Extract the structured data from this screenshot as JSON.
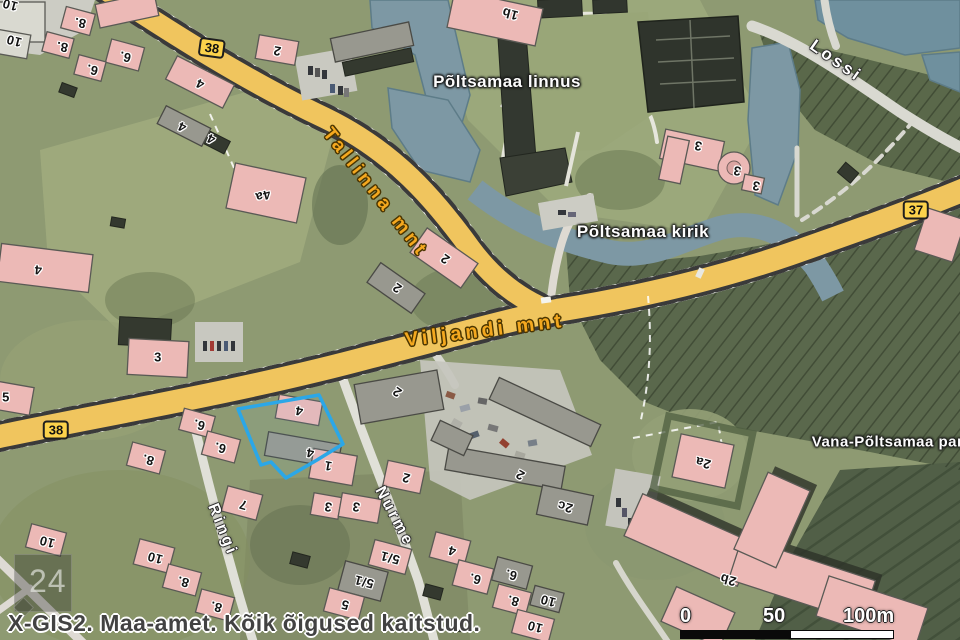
{
  "app": {
    "attribution": "X-GIS2. Maa-amet. Kõik õigused kaitstud."
  },
  "scalebar": {
    "start": "0",
    "mid": "50",
    "end": "100m"
  },
  "grid": {
    "sheet": "24"
  },
  "roads": {
    "names": [
      {
        "text": "Tallinna mnt"
      },
      {
        "text": "Viljandi mnt"
      },
      {
        "text": "Lossi"
      },
      {
        "text": "Nurme"
      },
      {
        "text": "Ringi"
      }
    ],
    "badges": [
      {
        "text": "38"
      },
      {
        "text": "37"
      },
      {
        "text": "38"
      }
    ]
  },
  "pois": [
    {
      "text": "Põltsamaa linnus"
    },
    {
      "text": "Põltsamaa kirik"
    },
    {
      "text": "Vana-Põltsamaa park"
    }
  ],
  "houses": [
    {
      "text": "10"
    },
    {
      "text": "8."
    },
    {
      "text": "10"
    },
    {
      "text": "8."
    },
    {
      "text": "6."
    },
    {
      "text": "6."
    },
    {
      "text": "4"
    },
    {
      "text": "4"
    },
    {
      "text": "4"
    },
    {
      "text": "2"
    },
    {
      "text": "4a"
    },
    {
      "text": "4"
    },
    {
      "text": "1b"
    },
    {
      "text": "2"
    },
    {
      "text": "2"
    },
    {
      "text": "3"
    },
    {
      "text": "3"
    },
    {
      "text": "3"
    },
    {
      "text": "3"
    },
    {
      "text": "5"
    },
    {
      "text": "6."
    },
    {
      "text": "6."
    },
    {
      "text": "8."
    },
    {
      "text": "7"
    },
    {
      "text": "4"
    },
    {
      "text": "4"
    },
    {
      "text": "1"
    },
    {
      "text": "3"
    },
    {
      "text": "3"
    },
    {
      "text": "2"
    },
    {
      "text": "2"
    },
    {
      "text": "2"
    },
    {
      "text": "2c"
    },
    {
      "text": "5/1"
    },
    {
      "text": "5/1"
    },
    {
      "text": "5"
    },
    {
      "text": "4"
    },
    {
      "text": "6."
    },
    {
      "text": "6."
    },
    {
      "text": "8."
    },
    {
      "text": "10"
    },
    {
      "text": "10"
    },
    {
      "text": "10"
    },
    {
      "text": "10"
    },
    {
      "text": "8."
    },
    {
      "text": "8."
    },
    {
      "text": "2a"
    },
    {
      "text": "2b"
    }
  ],
  "colors": {
    "highlight": "#2ba7e8",
    "road_yellow": "#f0c55e",
    "water": "#7d98a4",
    "building_pink": "#ecb9b6",
    "building_gray": "#98988f",
    "forest": "#5a684a",
    "road_label_orange": "#f4a81f"
  }
}
